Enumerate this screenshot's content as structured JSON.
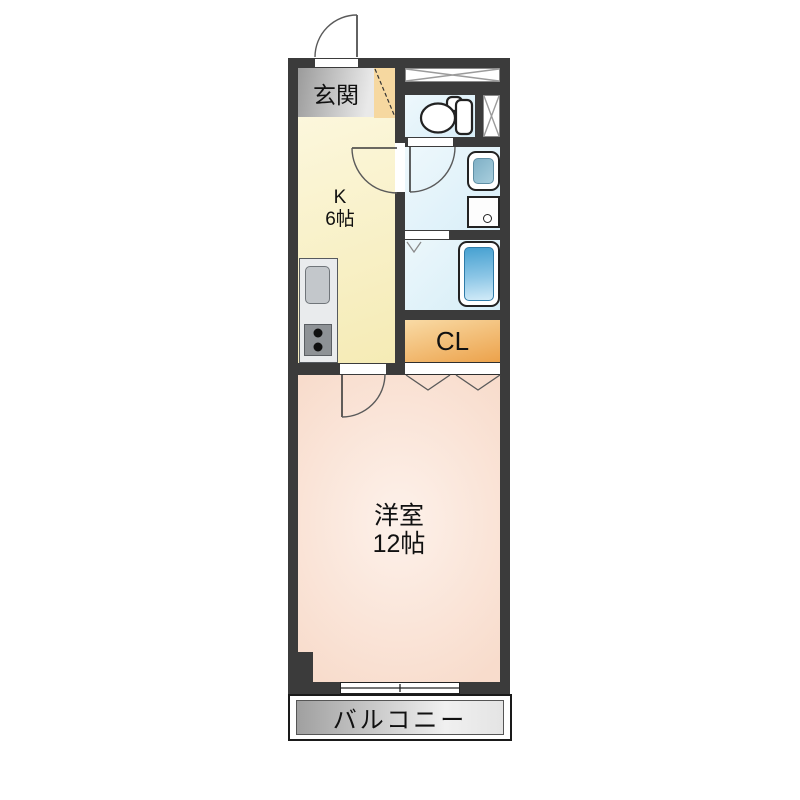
{
  "plan": {
    "labels": {
      "genkan": "玄関",
      "kitchen": "K",
      "kitchen_size": "6帖",
      "closet": "CL",
      "western_room": "洋室",
      "western_room_size": "12帖",
      "balcony": "バルコニー"
    },
    "icons": [
      "entrance-door-swing-icon",
      "kitchen-door-swing-icon",
      "washroom-door-swing-icon",
      "room-door-swing-icon",
      "toilet-icon",
      "washbasin-icon",
      "washing-machine-pan-icon",
      "bathtub-icon",
      "kitchen-sink-icon",
      "stove-burners-icon",
      "pipe-space-x-icon",
      "meter-box-x-icon",
      "folding-door-chevron-icon",
      "bath-folding-door-icon",
      "sliding-window-icon",
      "shoe-cabinet-diagonal-icon"
    ],
    "colors": {
      "wall": "#3b3b3b",
      "kitchen_floor": "#f8efbf",
      "genkan_floor": "#b5b5b5",
      "shoe_cabinet": "#f6d8a0",
      "wet_area_floor": "#def1f9",
      "closet": "#efa94f",
      "western_room_floor": "#f9ddcd",
      "balcony_floor": "#c9c9c9",
      "bathtub": "#5aabd6",
      "washbasin_bowl": "#8fbcd0"
    }
  }
}
